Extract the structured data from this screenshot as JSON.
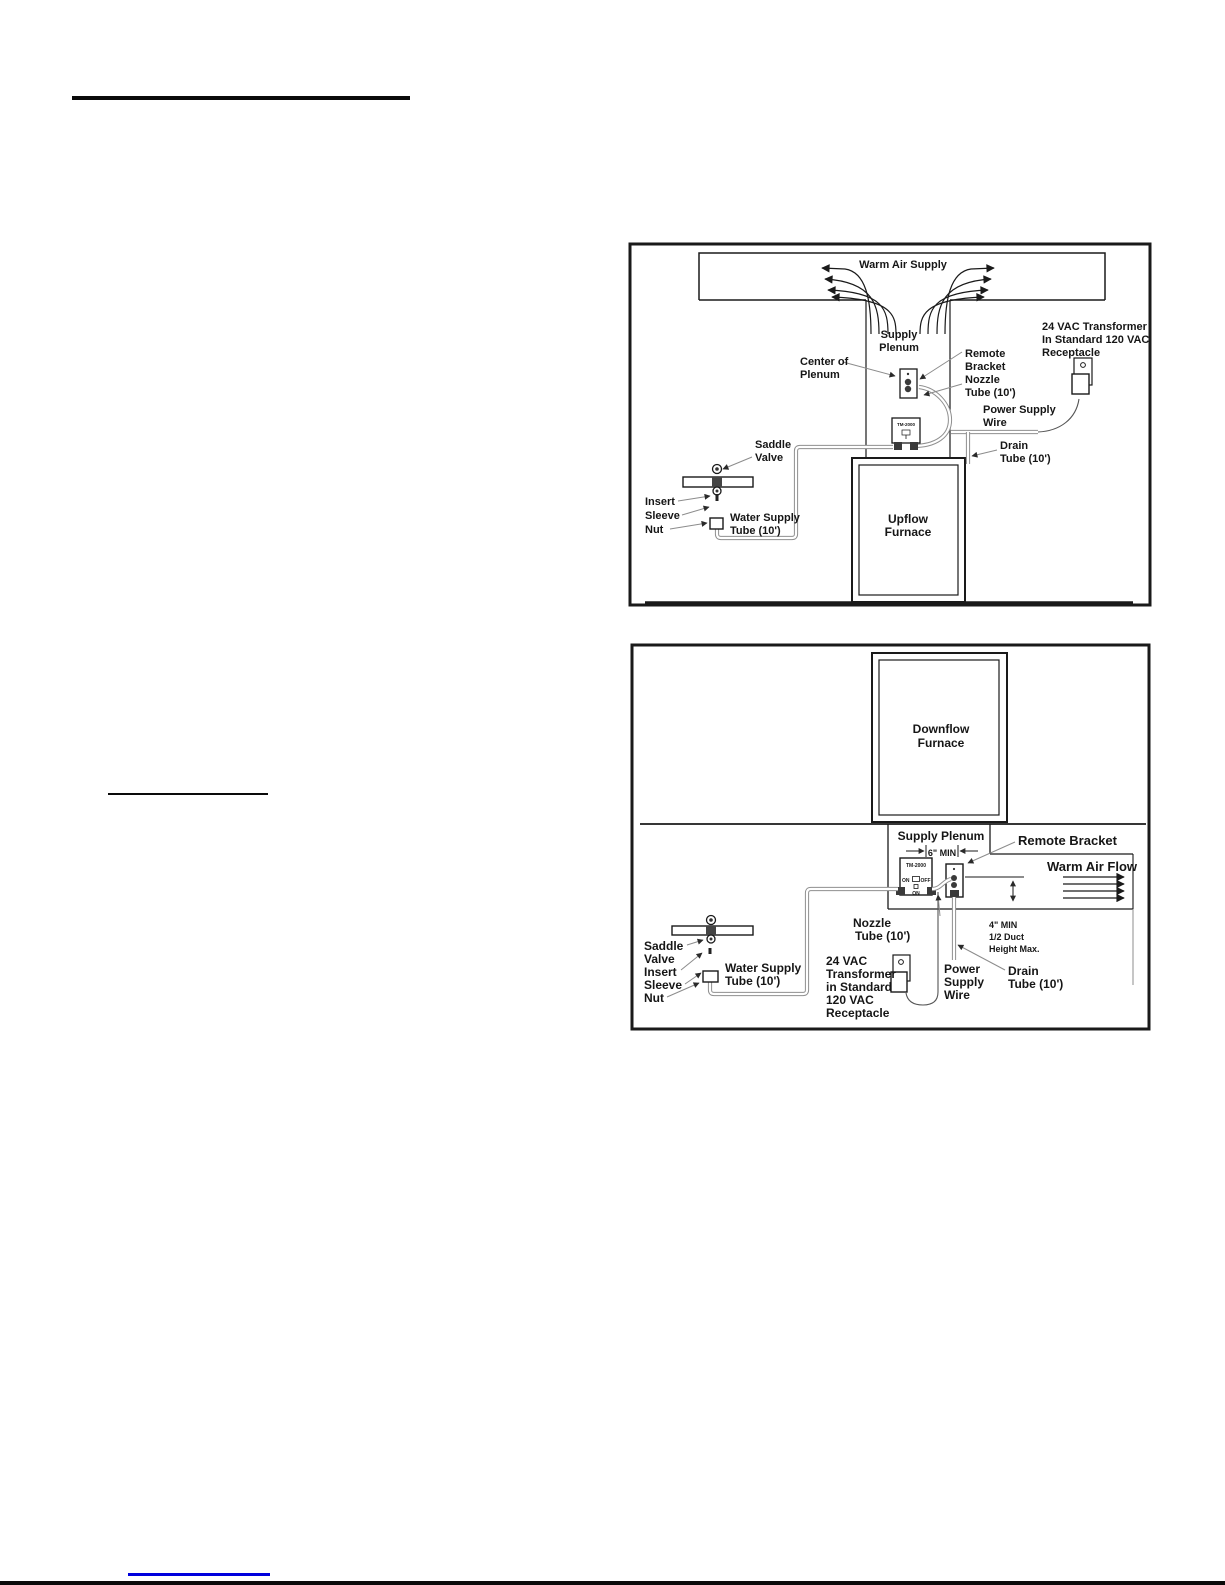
{
  "colors": {
    "link_blue": "#0000dd"
  },
  "fig1": {
    "warm_air": "Warm Air Supply",
    "supply1": "Supply",
    "supply2": "Plenum",
    "center1": "Center of",
    "center2": "Plenum",
    "remote1": "Remote",
    "remote2": "Bracket",
    "nozzle1": "Nozzle",
    "nozzle2": "Tube (10')",
    "xfmr1": "24 VAC Transformer",
    "xfmr2": "In Standard 120 VAC",
    "xfmr3": "Receptacle",
    "power1": "Power Supply",
    "power2": "Wire",
    "drain1": "Drain",
    "drain2": "Tube (10')",
    "saddle1": "Saddle",
    "saddle2": "Valve",
    "insert": "Insert",
    "sleeve": "Sleeve",
    "nut": "Nut",
    "water1": "Water Supply",
    "water2": "Tube (10')",
    "furnace1": "Upflow",
    "furnace2": "Furnace",
    "unit_model": "TM-2000"
  },
  "fig2": {
    "furnace1": "Downflow",
    "furnace2": "Furnace",
    "supply_plenum": "Supply Plenum",
    "six_min": "6\" MIN",
    "remote_bracket": "Remote Bracket",
    "warm_air_flow": "Warm Air Flow",
    "nozzle1": "Nozzle",
    "nozzle2": "Tube (10')",
    "four_min": "4\" MIN",
    "half_duct": "1/2 Duct",
    "height_max": "Height Max.",
    "drain1": "Drain",
    "drain2": "Tube (10')",
    "power1": "Power",
    "power2": "Supply",
    "power3": "Wire",
    "xfmr1": "24 VAC",
    "xfmr2": "Transformer",
    "xfmr3": "in Standard",
    "xfmr4": "120 VAC",
    "xfmr5": "Receptacle",
    "water1": "Water Supply",
    "water2": "Tube (10')",
    "saddle": "Saddle",
    "valve": "Valve",
    "insert": "Insert",
    "sleeve": "Sleeve",
    "nut": "Nut",
    "unit_model": "TM-2000",
    "on": "ON",
    "off": "OFF",
    "on_bottom": "ON"
  }
}
